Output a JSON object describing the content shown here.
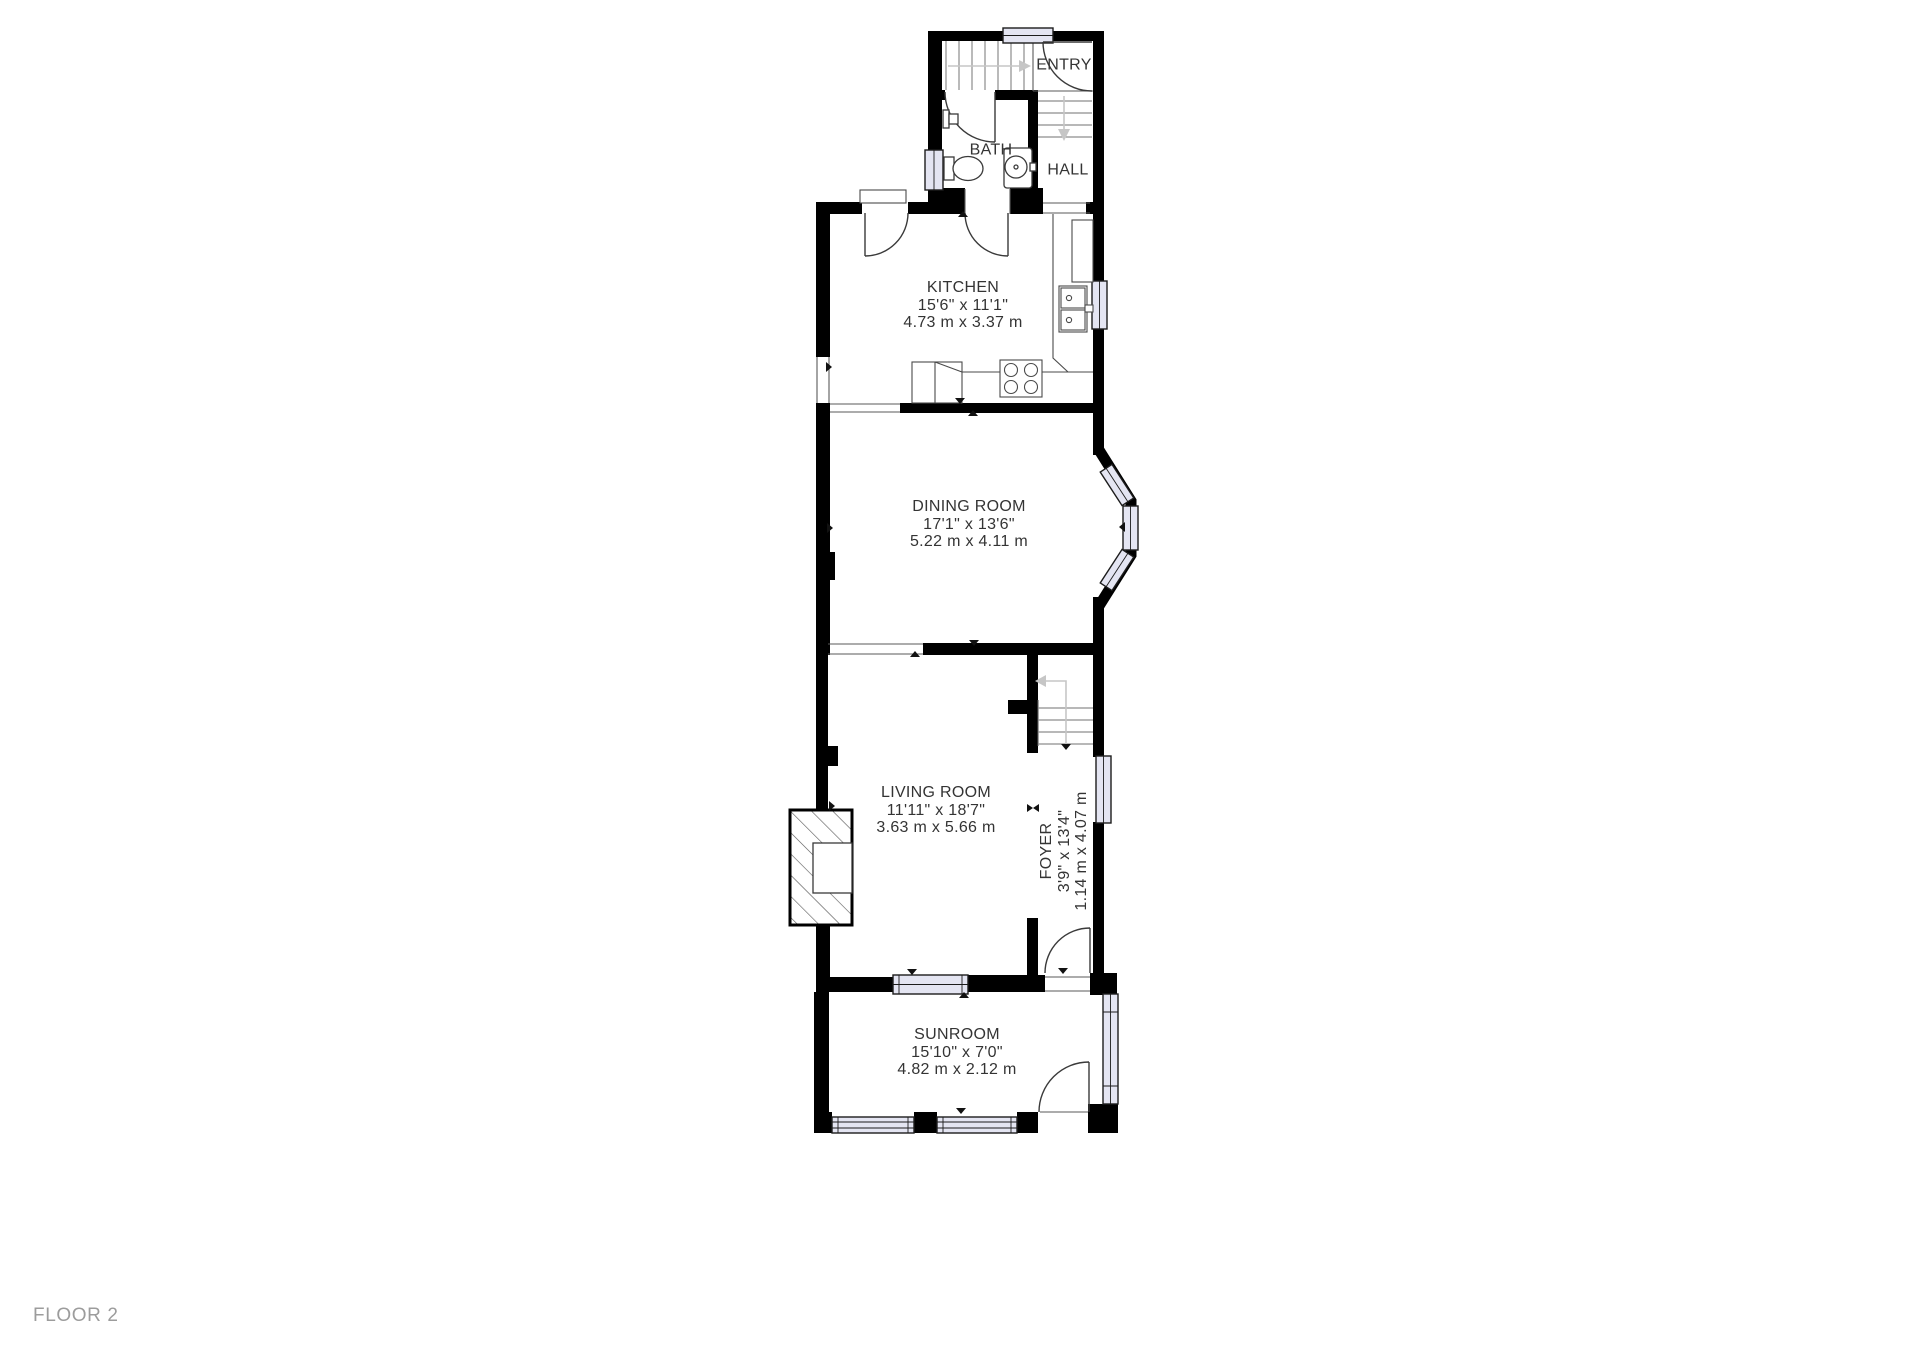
{
  "floor_label": "FLOOR 2",
  "rooms": {
    "entry": {
      "name": "ENTRY"
    },
    "bath": {
      "name": "BATH"
    },
    "hall": {
      "name": "HALL"
    },
    "kitchen": {
      "name": "KITCHEN",
      "imperial": "15'6\" x 11'1\"",
      "metric": "4.73 m x 3.37 m"
    },
    "dining_room": {
      "name": "DINING ROOM",
      "imperial": "17'1\" x 13'6\"",
      "metric": "5.22 m x 4.11 m"
    },
    "living_room": {
      "name": "LIVING ROOM",
      "imperial": "11'11\" x 18'7\"",
      "metric": "3.63 m x 5.66 m"
    },
    "foyer": {
      "name": "FOYER",
      "imperial": "3'9\" x 13'4\"",
      "metric": "1.14 m x 4.07 m"
    },
    "sunroom": {
      "name": "SUNROOM",
      "imperial": "15'10\" x 7'0\"",
      "metric": "4.82 m x 2.12 m"
    }
  },
  "colors": {
    "wall": "#000000",
    "window_fill": "#e4e5f2",
    "window_stroke": "#1c1c1c",
    "thin_line": "#5a5a5a",
    "stair_tread": "#8d8d8d",
    "stair_path": "#c6c6c6",
    "door_arc": "#3a3a3a",
    "fixture_stroke": "#3a3a3a",
    "label_text": "#343434",
    "floor_label_text": "#9c9c9c",
    "background": "#ffffff"
  }
}
